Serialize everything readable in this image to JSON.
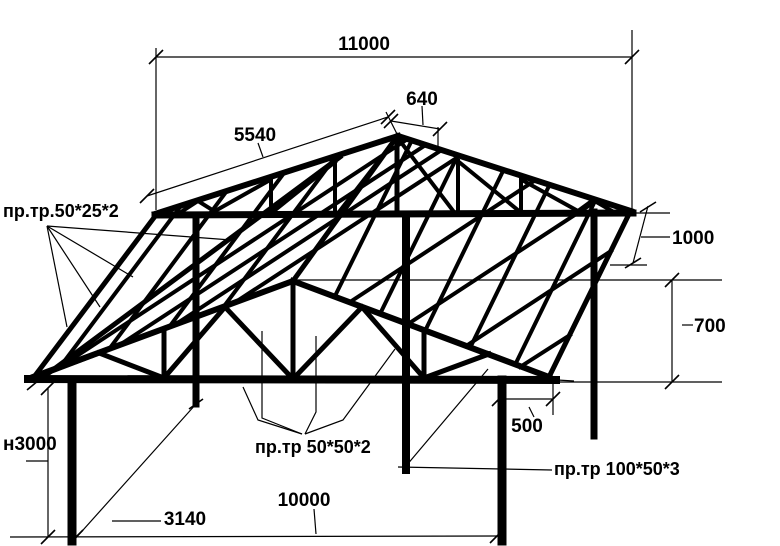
{
  "drawing": {
    "type": "structural-frame-sketch",
    "background_color": "#ffffff",
    "line_color": "#000000",
    "dims": {
      "overall_length": "11000",
      "slope_length": "5540",
      "ridge_segment": "640",
      "rear_overhang": "1000",
      "truss_rise": "700",
      "side_overhang": "500",
      "column_height": "н3000",
      "depth_spacing": "3140",
      "column_span": "10000"
    },
    "labels": {
      "purlin_profile": "пр.тр.50*25*2",
      "truss_profile": "пр.тр 50*50*2",
      "column_profile": "пр.тр 100*50*3"
    }
  }
}
